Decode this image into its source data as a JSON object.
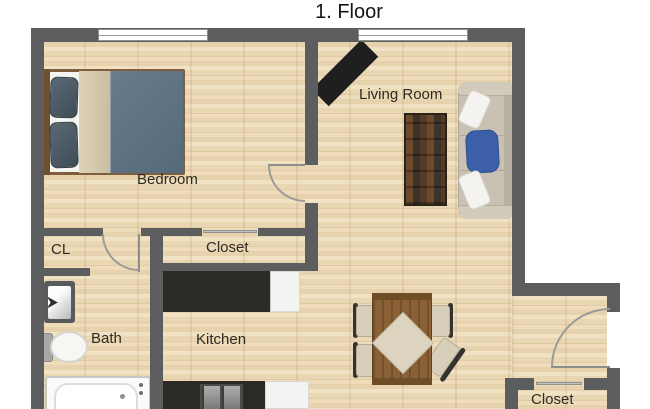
{
  "title": "1. Floor",
  "rooms": {
    "bedroom": {
      "label": "Bedroom"
    },
    "living_room": {
      "label": "Living Room"
    },
    "cl": {
      "label": "CL"
    },
    "hall_closet": {
      "label": "Closet"
    },
    "bath": {
      "label": "Bath"
    },
    "kitchen": {
      "label": "Kitchen"
    },
    "entry_closet": {
      "label": "Closet"
    }
  },
  "furniture": {
    "bedroom": [
      "double-bed",
      "pillows",
      "blanket",
      "duvet"
    ],
    "living_room": [
      "tv",
      "coffee-table",
      "sofa",
      "white-throw-pillow",
      "blue-throw-pillow",
      "white-throw-pillow"
    ],
    "dining_area": [
      "dining-table",
      "tablecloth",
      "chair",
      "chair",
      "chair",
      "chair"
    ],
    "bath": [
      "sink",
      "toilet",
      "bathtub"
    ],
    "kitchen": [
      "counter",
      "refrigerator",
      "stove",
      "counter"
    ],
    "doors": [
      "bedroom-door",
      "bath-door",
      "entry-door",
      "closet-sliding-door",
      "closet-sliding-door"
    ],
    "windows": [
      "bedroom-window",
      "living-room-window"
    ]
  },
  "colors": {
    "wall": "#5c5d5f",
    "floor_base": "#ead7b5",
    "counter_dark": "#2b2a27",
    "sofa": "#c9c2b3",
    "bed_duvet": "#5e7383",
    "bed_pillow": "#46545e",
    "blanket": "#d5c9af",
    "accent_pillow": "#3d5fa9",
    "tv": "#1f1f1f",
    "table_wood": "#8a6137",
    "tablecloth": "#ddd4c0",
    "chair_seat": "#d8cfbb"
  }
}
